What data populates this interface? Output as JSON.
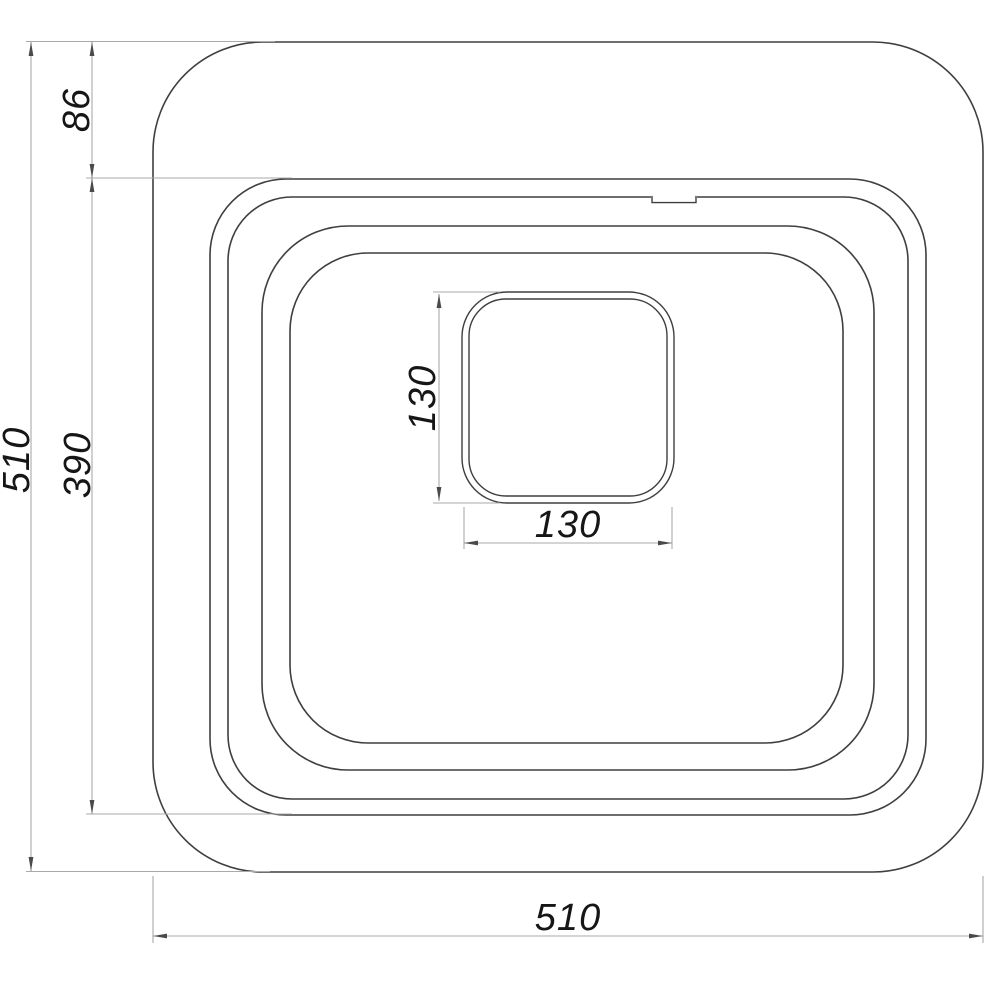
{
  "drawing": {
    "description": "Technical drawing, top view of square sink with drain",
    "background": "#ffffff",
    "line_color": "#3f3f3f",
    "dimension_line_color": "#a9a9a9",
    "arrow_color": "#4a4a4a",
    "text_color": "#161616",
    "dimensions": {
      "overall_height": {
        "label": "510",
        "orientation": "vertical",
        "side": "left-outer"
      },
      "top_rim_offset": {
        "label": "86",
        "orientation": "vertical",
        "side": "left-inner-top"
      },
      "rim_height": {
        "label": "390",
        "orientation": "vertical",
        "side": "left-inner"
      },
      "drain_height": {
        "label": "130",
        "orientation": "vertical",
        "side": "center"
      },
      "drain_width": {
        "label": "130",
        "orientation": "horizontal",
        "side": "center"
      },
      "overall_width": {
        "label": "510",
        "orientation": "horizontal",
        "side": "bottom"
      }
    }
  }
}
